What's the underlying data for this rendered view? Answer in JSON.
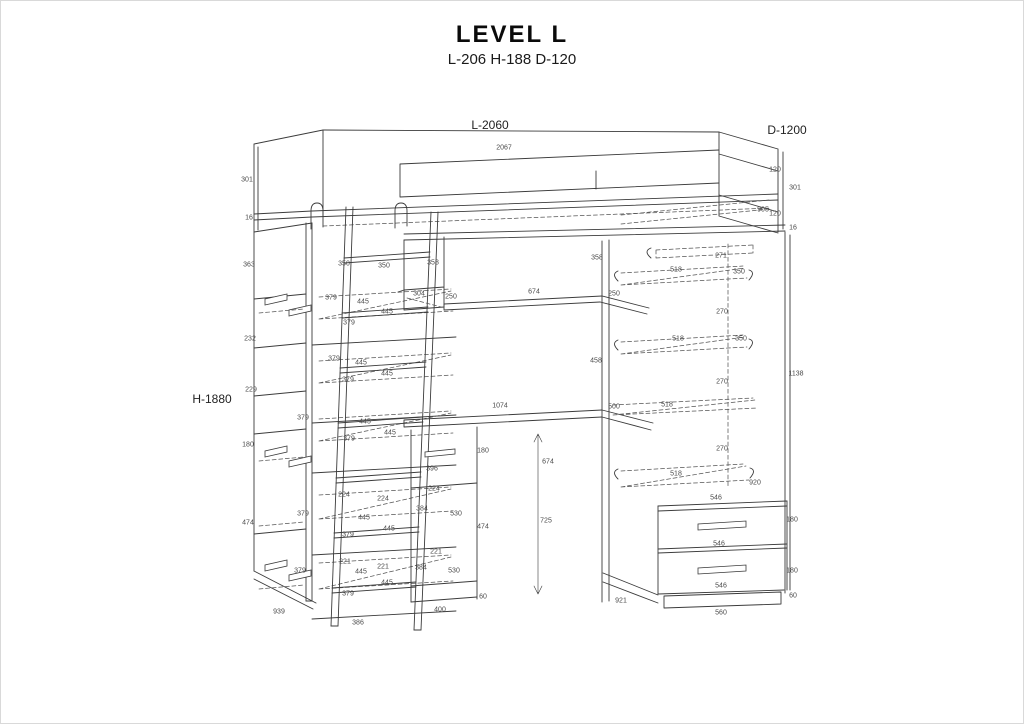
{
  "page": {
    "background": "#ffffff",
    "border_color": "#d9d9d9",
    "line_color": "#3b3b3b"
  },
  "header": {
    "title": "LEVEL L",
    "subtitle": "L-206 H-188 D-120"
  },
  "diagram": {
    "type": "furniture-assembly-line-drawing",
    "product": "loft bed with ladder, shelving, desk and wardrobe",
    "primary_dimensions": [
      {
        "text": "L-2060",
        "x": 489,
        "y": 124
      },
      {
        "text": "D-1200",
        "x": 786,
        "y": 129
      },
      {
        "text": "H-1880",
        "x": 211,
        "y": 398
      }
    ],
    "dimension_labels": [
      {
        "text": "2067",
        "x": 503,
        "y": 147
      },
      {
        "text": "301",
        "x": 246,
        "y": 179
      },
      {
        "text": "16",
        "x": 248,
        "y": 217
      },
      {
        "text": "120",
        "x": 774,
        "y": 169
      },
      {
        "text": "301",
        "x": 794,
        "y": 187
      },
      {
        "text": "905",
        "x": 762,
        "y": 209
      },
      {
        "text": "120",
        "x": 774,
        "y": 213
      },
      {
        "text": "16",
        "x": 792,
        "y": 227
      },
      {
        "text": "363",
        "x": 248,
        "y": 264
      },
      {
        "text": "232",
        "x": 249,
        "y": 338
      },
      {
        "text": "229",
        "x": 250,
        "y": 389
      },
      {
        "text": "180",
        "x": 247,
        "y": 444
      },
      {
        "text": "474",
        "x": 247,
        "y": 522
      },
      {
        "text": "939",
        "x": 278,
        "y": 611
      },
      {
        "text": "350",
        "x": 343,
        "y": 263
      },
      {
        "text": "350",
        "x": 383,
        "y": 265
      },
      {
        "text": "379",
        "x": 330,
        "y": 297
      },
      {
        "text": "445",
        "x": 362,
        "y": 301
      },
      {
        "text": "445",
        "x": 386,
        "y": 311
      },
      {
        "text": "379",
        "x": 348,
        "y": 322
      },
      {
        "text": "379",
        "x": 333,
        "y": 358
      },
      {
        "text": "445",
        "x": 360,
        "y": 362
      },
      {
        "text": "445",
        "x": 386,
        "y": 373
      },
      {
        "text": "379",
        "x": 347,
        "y": 379
      },
      {
        "text": "379",
        "x": 302,
        "y": 417
      },
      {
        "text": "445",
        "x": 364,
        "y": 421
      },
      {
        "text": "445",
        "x": 389,
        "y": 432
      },
      {
        "text": "379",
        "x": 348,
        "y": 438
      },
      {
        "text": "224",
        "x": 343,
        "y": 494
      },
      {
        "text": "224",
        "x": 382,
        "y": 498
      },
      {
        "text": "379",
        "x": 302,
        "y": 513
      },
      {
        "text": "445",
        "x": 363,
        "y": 517
      },
      {
        "text": "445",
        "x": 388,
        "y": 528
      },
      {
        "text": "379",
        "x": 347,
        "y": 534
      },
      {
        "text": "221",
        "x": 344,
        "y": 561
      },
      {
        "text": "221",
        "x": 382,
        "y": 566
      },
      {
        "text": "379",
        "x": 299,
        "y": 570
      },
      {
        "text": "445",
        "x": 360,
        "y": 571
      },
      {
        "text": "445",
        "x": 386,
        "y": 582
      },
      {
        "text": "379",
        "x": 347,
        "y": 593
      },
      {
        "text": "386",
        "x": 357,
        "y": 622
      },
      {
        "text": "358",
        "x": 432,
        "y": 262
      },
      {
        "text": "304",
        "x": 418,
        "y": 293
      },
      {
        "text": "250",
        "x": 450,
        "y": 296
      },
      {
        "text": "674",
        "x": 533,
        "y": 291
      },
      {
        "text": "358",
        "x": 596,
        "y": 257
      },
      {
        "text": "250",
        "x": 613,
        "y": 293
      },
      {
        "text": "458",
        "x": 595,
        "y": 360
      },
      {
        "text": "1074",
        "x": 499,
        "y": 405
      },
      {
        "text": "180",
        "x": 482,
        "y": 450
      },
      {
        "text": "396",
        "x": 431,
        "y": 468
      },
      {
        "text": "224",
        "x": 433,
        "y": 488
      },
      {
        "text": "384",
        "x": 421,
        "y": 508
      },
      {
        "text": "530",
        "x": 455,
        "y": 513
      },
      {
        "text": "474",
        "x": 482,
        "y": 526
      },
      {
        "text": "221",
        "x": 435,
        "y": 551
      },
      {
        "text": "384",
        "x": 420,
        "y": 567
      },
      {
        "text": "530",
        "x": 453,
        "y": 570
      },
      {
        "text": "60",
        "x": 482,
        "y": 596
      },
      {
        "text": "400",
        "x": 439,
        "y": 609
      },
      {
        "text": "674",
        "x": 547,
        "y": 461
      },
      {
        "text": "725",
        "x": 545,
        "y": 520
      },
      {
        "text": "271",
        "x": 720,
        "y": 255
      },
      {
        "text": "518",
        "x": 675,
        "y": 269
      },
      {
        "text": "350",
        "x": 738,
        "y": 271
      },
      {
        "text": "270",
        "x": 721,
        "y": 311
      },
      {
        "text": "518",
        "x": 677,
        "y": 338
      },
      {
        "text": "350",
        "x": 740,
        "y": 338
      },
      {
        "text": "270",
        "x": 721,
        "y": 381
      },
      {
        "text": "1138",
        "x": 795,
        "y": 373
      },
      {
        "text": "500",
        "x": 613,
        "y": 406
      },
      {
        "text": "518",
        "x": 666,
        "y": 404
      },
      {
        "text": "270",
        "x": 721,
        "y": 448
      },
      {
        "text": "518",
        "x": 675,
        "y": 473
      },
      {
        "text": "920",
        "x": 754,
        "y": 482
      },
      {
        "text": "546",
        "x": 715,
        "y": 497
      },
      {
        "text": "180",
        "x": 791,
        "y": 519
      },
      {
        "text": "546",
        "x": 718,
        "y": 543
      },
      {
        "text": "180",
        "x": 791,
        "y": 570
      },
      {
        "text": "546",
        "x": 720,
        "y": 585
      },
      {
        "text": "60",
        "x": 792,
        "y": 595
      },
      {
        "text": "560",
        "x": 720,
        "y": 612
      },
      {
        "text": "921",
        "x": 620,
        "y": 600
      }
    ]
  }
}
